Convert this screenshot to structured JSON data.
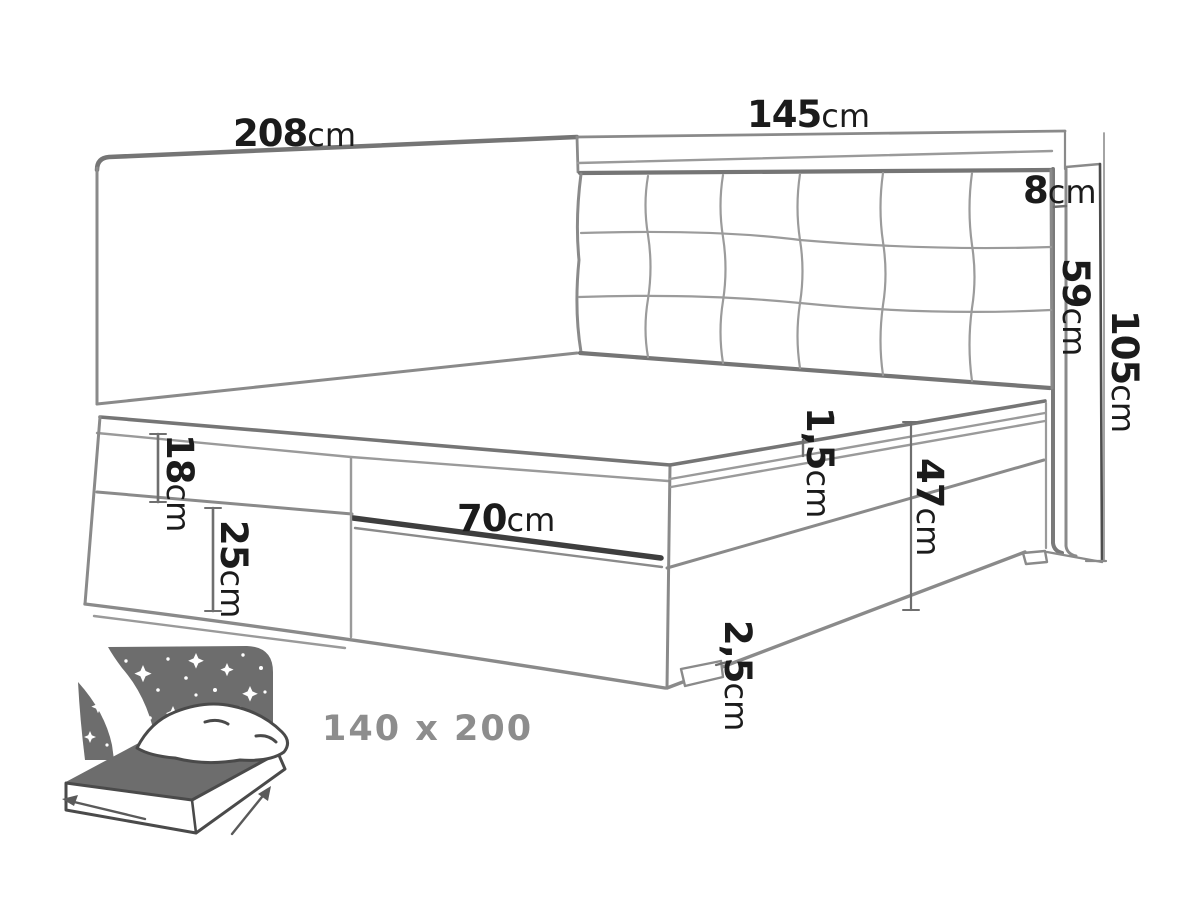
{
  "diagram": {
    "type": "bed-dimension-drawing",
    "dims": {
      "panel_length": {
        "value": "208",
        "unit": "cm"
      },
      "headboard_width": {
        "value": "145",
        "unit": "cm"
      },
      "frame_top_reveal": {
        "value": "8",
        "unit": "cm"
      },
      "headboard_cushion_height": {
        "value": "59",
        "unit": "cm"
      },
      "panel_total_height": {
        "value": "105",
        "unit": "cm"
      },
      "mattress_height": {
        "value": "18",
        "unit": "cm"
      },
      "corpus_height": {
        "value": "25",
        "unit": "cm"
      },
      "flap_width": {
        "value": "70",
        "unit": "cm"
      },
      "mattress_gap": {
        "value": "1,5",
        "unit": "cm"
      },
      "base_height": {
        "value": "47",
        "unit": "cm"
      },
      "feet_height": {
        "value": "2,5",
        "unit": "cm"
      }
    },
    "badge": {
      "size_label": "140 x 200"
    },
    "colors": {
      "line_gray": "#8a8a8a",
      "edge_gray": "#757575",
      "dark_seam": "#3e3e3e",
      "text_dark": "#1b1b1b",
      "icon_gray": "#6d6d6d",
      "badge_text_gray": "#8d8d8d",
      "background": "#ffffff"
    }
  }
}
